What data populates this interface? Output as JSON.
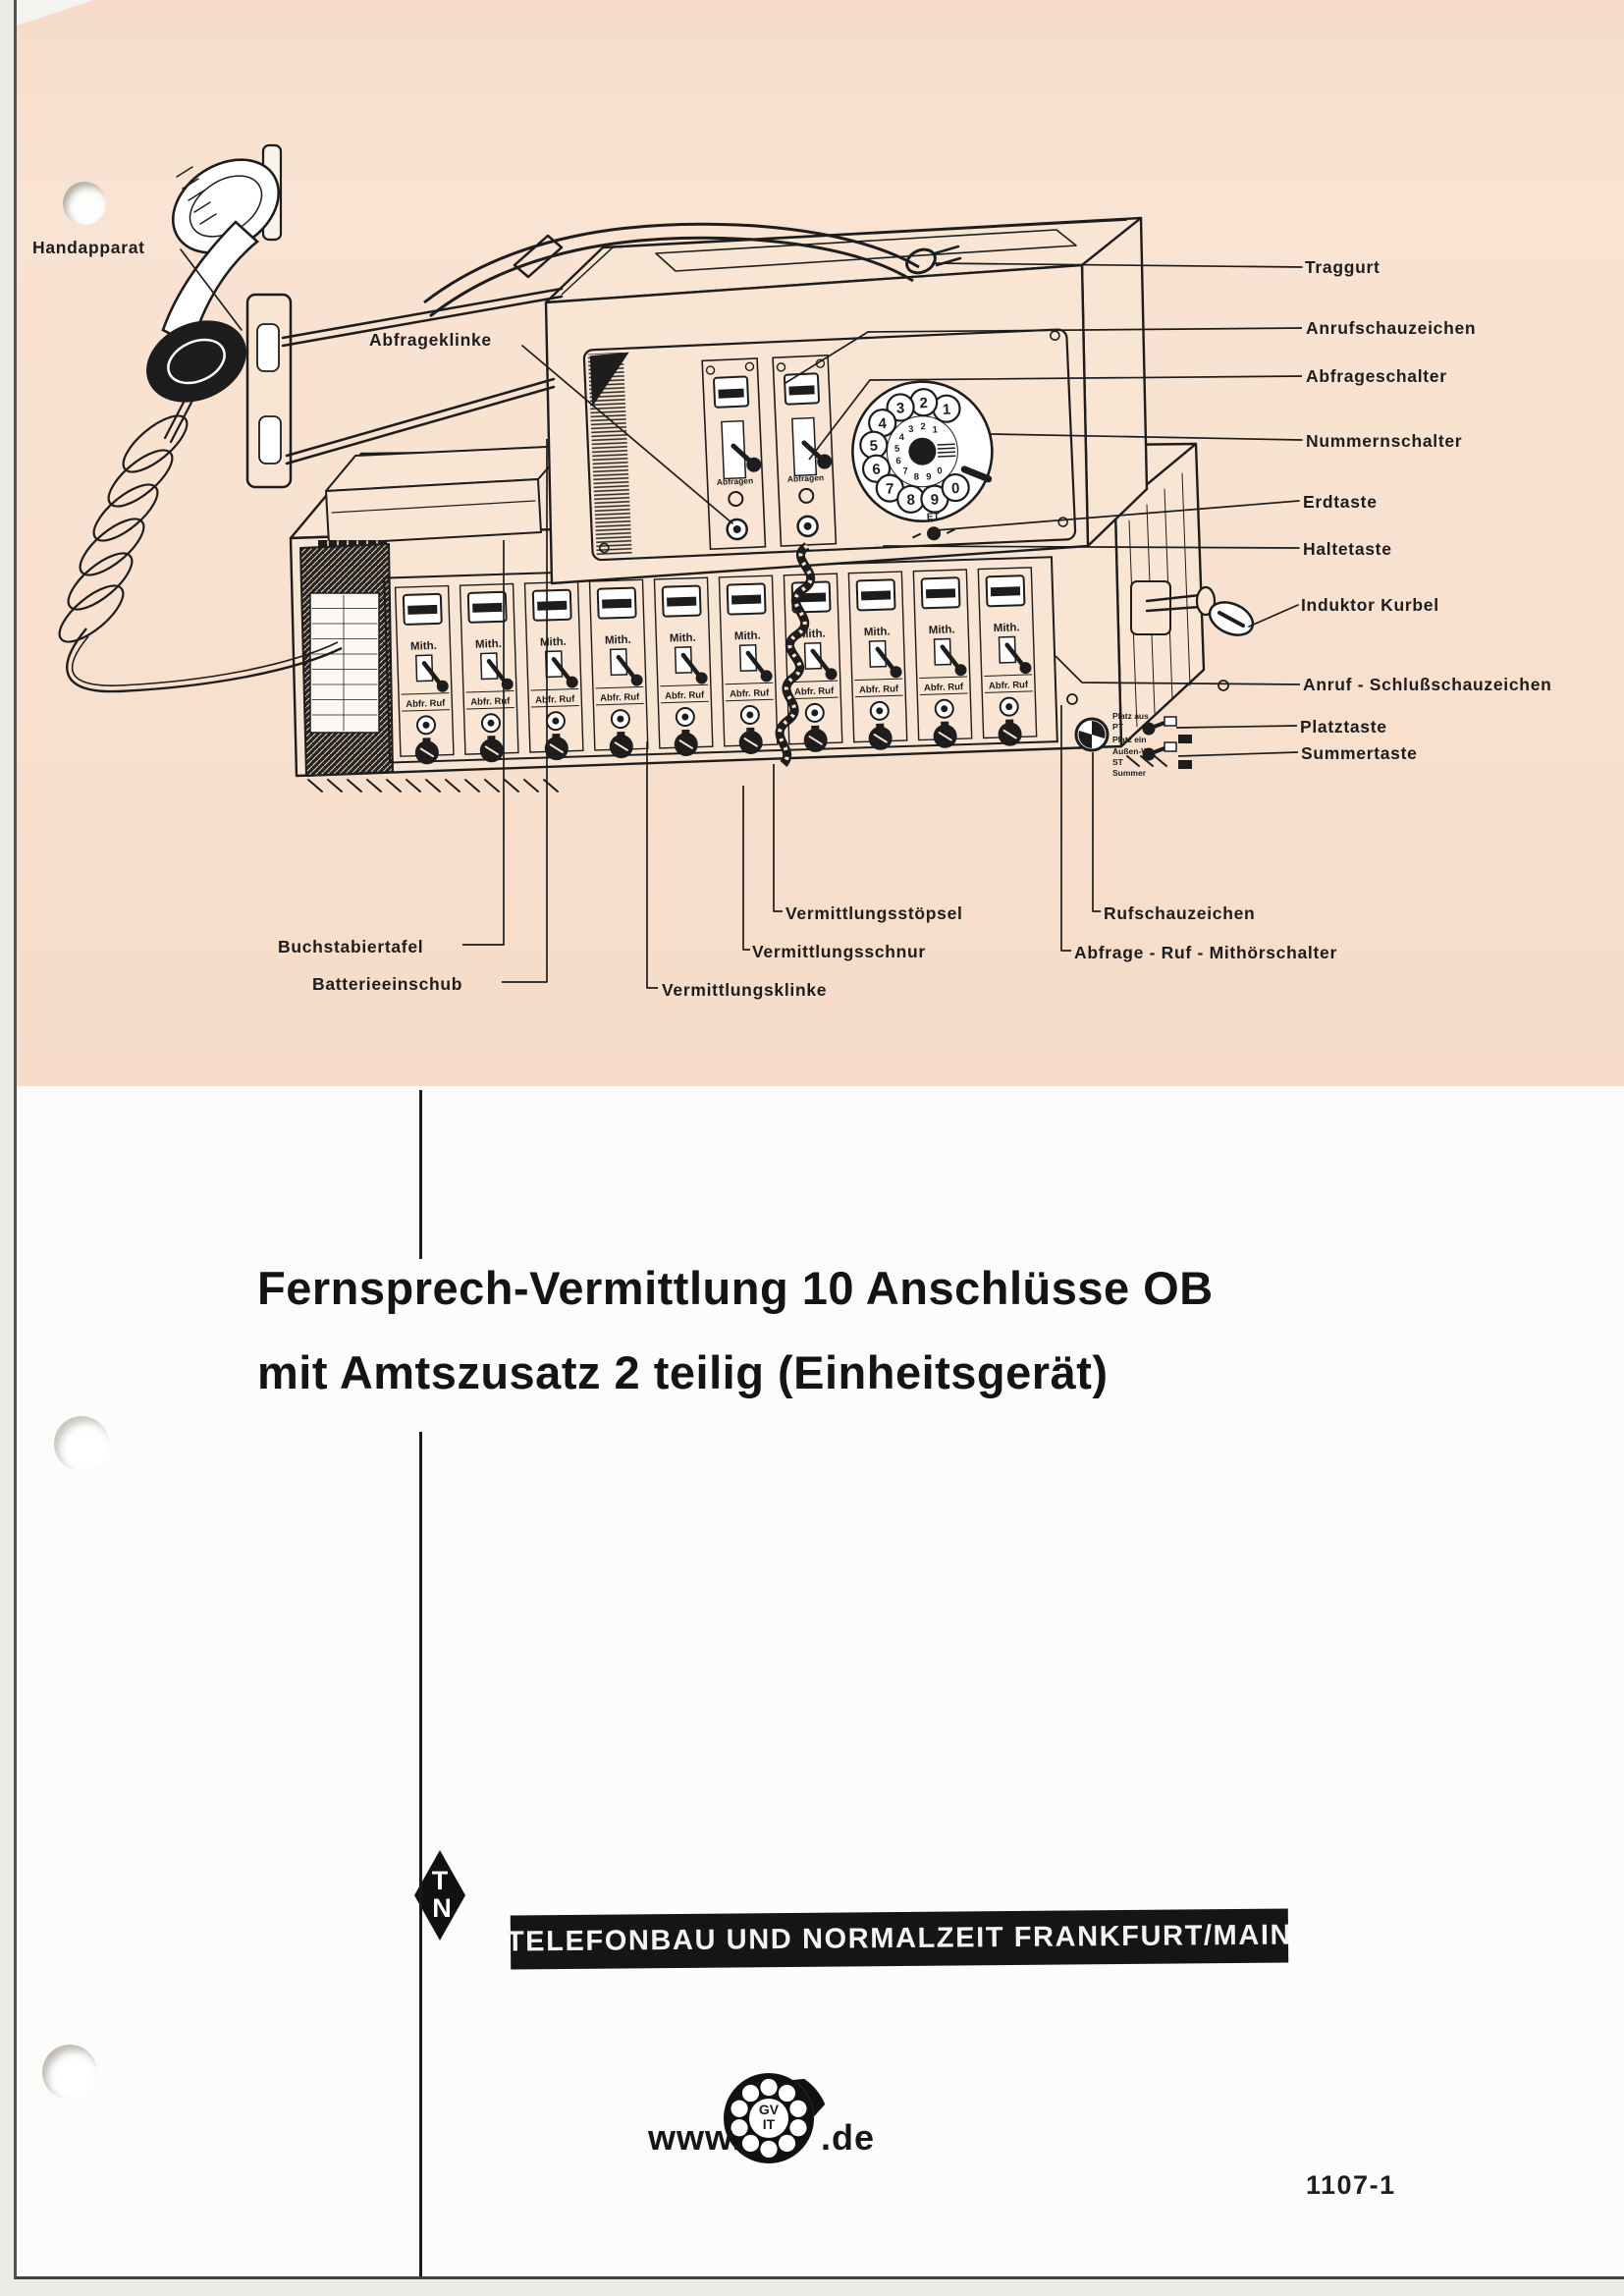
{
  "diagram": {
    "callouts": [
      {
        "label": "Handapparat"
      },
      {
        "label": "Abfrageklinke"
      },
      {
        "label": "Traggurt"
      },
      {
        "label": "Anrufschauzeichen"
      },
      {
        "label": "Abfrageschalter"
      },
      {
        "label": "Nummernschalter"
      },
      {
        "label": "Erdtaste"
      },
      {
        "label": "Haltetaste"
      },
      {
        "label": "Induktor Kurbel"
      },
      {
        "label": "Anruf - Schlußschauzeichen"
      },
      {
        "label": "Platztaste"
      },
      {
        "label": "Summertaste"
      },
      {
        "label": "Vermittlungsstöpsel"
      },
      {
        "label": "Vermittlungsschnur"
      },
      {
        "label": "Vermittlungsklinke"
      },
      {
        "label": "Rufschauzeichen"
      },
      {
        "label": "Abfrage - Ruf - Mithörschalter"
      },
      {
        "label": "Buchstabiertafel"
      },
      {
        "label": "Batterieeinschub"
      }
    ]
  },
  "device_panel": {
    "module_label": "Abfragen",
    "strip_top_label": "Mith.",
    "strip_bottom_label": "Abfr. Ruf",
    "dial_digits": [
      "1",
      "2",
      "3",
      "4",
      "5",
      "6",
      "7",
      "8",
      "9",
      "0"
    ],
    "earth_key_label": "ET",
    "side_switch_labels": [
      "Platz aus",
      "PT",
      "Platz ein",
      "Außen-W",
      "ST",
      "Summer"
    ]
  },
  "title": {
    "line1": "Fernsprech-Vermittlung 10 Anschlüsse OB",
    "line2": "mit Amtszusatz 2 teilig (Einheitsgerät)"
  },
  "brand": {
    "monogram_top": "T",
    "monogram_bottom": "N",
    "company_bar": "TELEFONBAU UND NORMALZEIT FRANKFURT/MAIN",
    "web_prefix": "www.",
    "web_suffix": ".de",
    "dial_logo_line1": "GV",
    "dial_logo_line2": "IT"
  },
  "footer": {
    "doc_number": "1107-1"
  },
  "colors": {
    "paper_pink": "#f8e1cf",
    "paper_white": "#fcfcfa",
    "ink": "#1d1d1d"
  }
}
